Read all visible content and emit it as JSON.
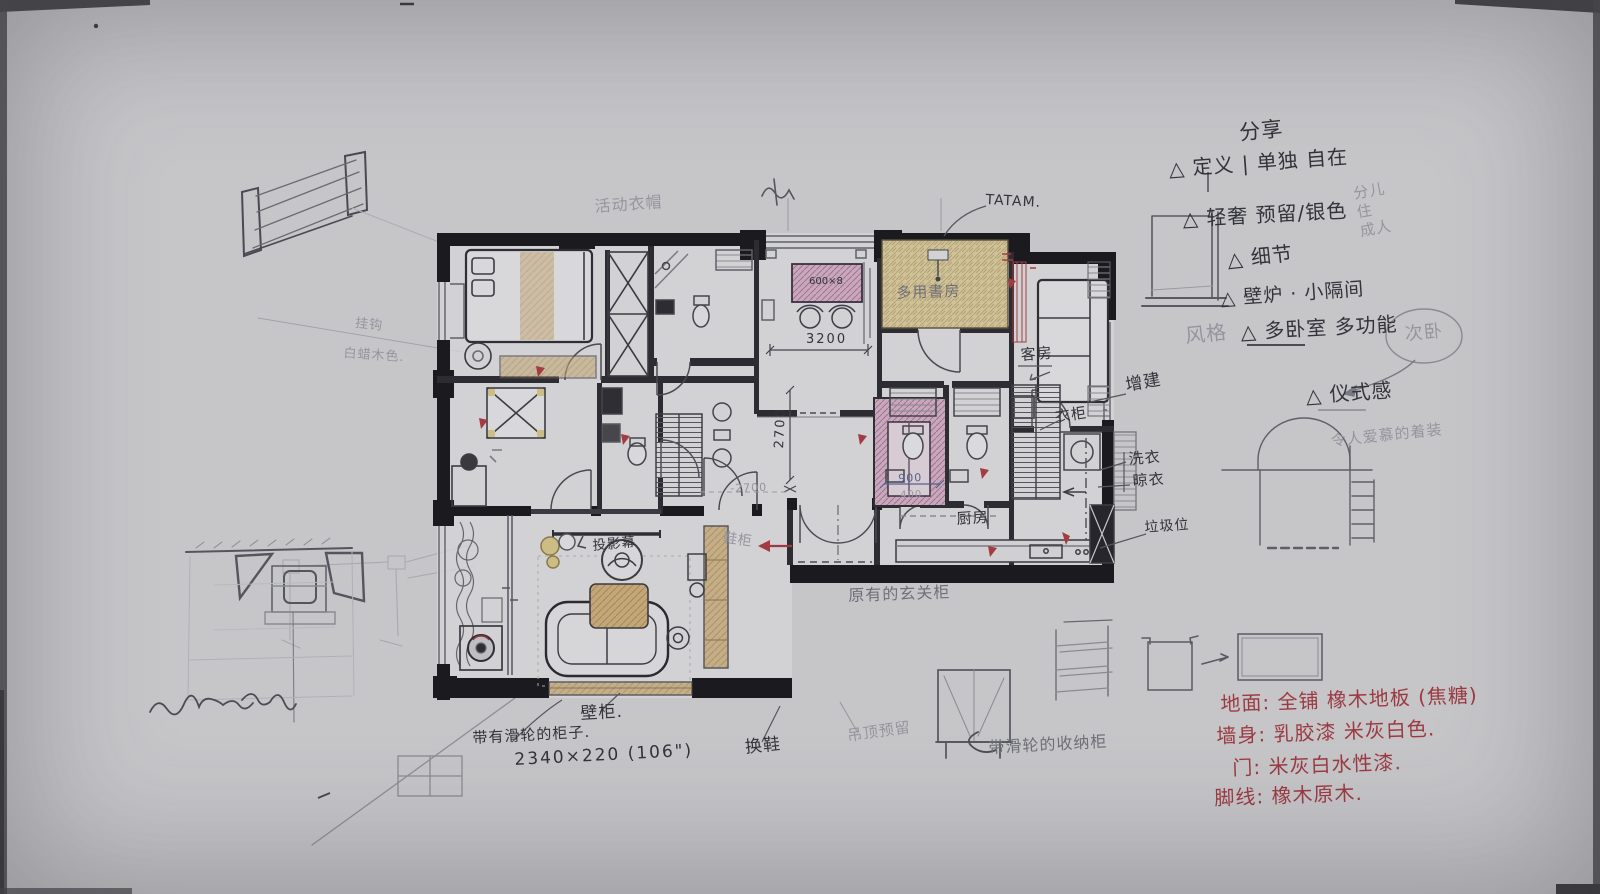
{
  "palette": {
    "paper": "#c6c6c9",
    "ink": "#33333b",
    "pencil": "#95959f",
    "red_ink": "#9c3a42",
    "pink_marker": "#c7a8bd",
    "yellow_marker": "#cfc29b",
    "wood_marker": "#c3a778"
  },
  "labels": {
    "note_share": "分享",
    "note_define": "△ 定义 | 单独  自在",
    "note_side": "分儿\n住\n成人",
    "note_luxury": "△ 轻奢  预留/银色",
    "note_detail": "△ 细节",
    "note_fireplace": "△ 壁炉 · 小隔间",
    "note_style": "风格",
    "note_multi": "△ 多卧室  多功能",
    "note_circle": "次卧",
    "note_ritual": "△ 仪式感",
    "note_dress": "令人爱慕的着装",
    "mat_floor": "地面: 全铺 橡木地板 (焦糖)",
    "mat_wall": "墙身: 乳胶漆 米灰白色.",
    "mat_door": "门: 米灰白水性漆.",
    "mat_skirting": "脚线: 橡木原木.",
    "tatami": "TATAM.",
    "closet_note": "活动衣帽",
    "study": "多用書房",
    "desk_dim": "600×8",
    "dim_3200": "3200",
    "guest": "客房",
    "wardrobe": "衣柜",
    "extension": "增建",
    "laundry": "洗衣",
    "drying": "晾衣",
    "trash": "垃圾位",
    "kitchen": "厨房",
    "dim_2700": "2700",
    "dim_2700b": "-2700",
    "dim_900": "900",
    "dim_400": "400",
    "old_cabinet": "原有的玄关柜",
    "projection": "投影幕",
    "shoe": "鞋柜",
    "wall_cabinet": "壁柜.",
    "wheel_cabinet": "带有滑轮的柜子.",
    "wheel_dim": "2340×220 (106\")",
    "change_shoes": "换鞋",
    "ceiling_note": "吊顶预留",
    "hook_note": "挂钩",
    "ash_note": "白蜡木色.",
    "storage_note": "带滑轮的收纳柜"
  }
}
